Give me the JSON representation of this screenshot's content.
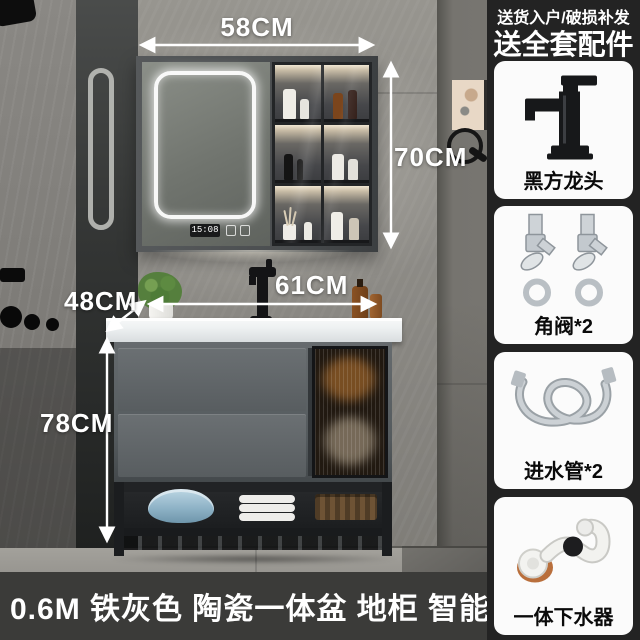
{
  "promo": {
    "line1": "送货入户/破损补发",
    "line2": "送全套配件"
  },
  "caption": "0.6M 铁灰色 陶瓷一体盆 地柜 智能镜柜",
  "measurements": {
    "mirror_width": "58CM",
    "mirror_height": "70CM",
    "counter_width": "61CM",
    "counter_depth": "48CM",
    "cabinet_height": "78CM"
  },
  "mirror": {
    "clock": "15:08"
  },
  "accessories": [
    {
      "label": "黑方龙头",
      "icon": "black-square-faucet-icon"
    },
    {
      "label": "角阀*2",
      "icon": "angle-valve-pair-icon"
    },
    {
      "label": "进水管*2",
      "icon": "inlet-hose-icon"
    },
    {
      "label": "一体下水器",
      "icon": "drain-trap-icon"
    }
  ],
  "colors": {
    "panel_bg": "#232323",
    "card_bg": "#fbfbfb",
    "caption_bg": "#3b3b39",
    "text_light": "#ffffff",
    "text_dark": "#0a0a0a"
  }
}
